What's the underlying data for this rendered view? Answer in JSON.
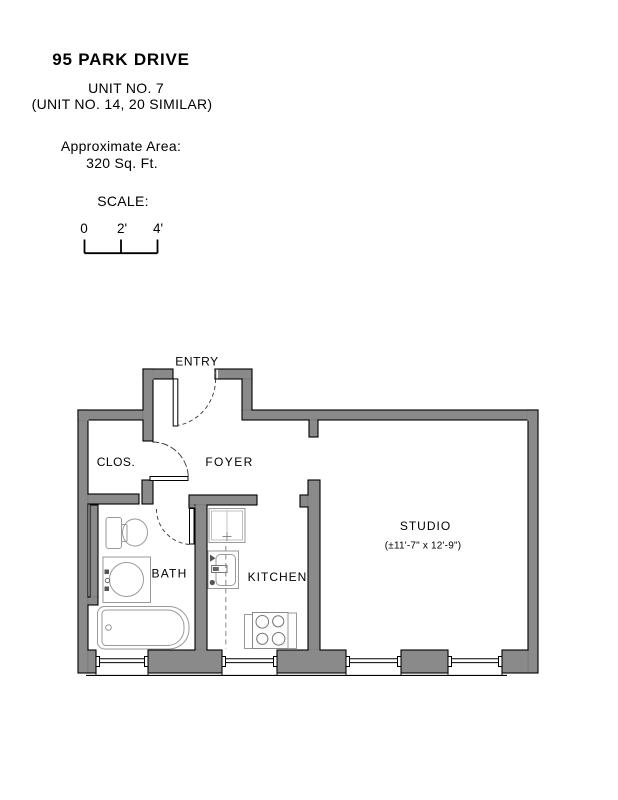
{
  "header": {
    "title": "95 PARK DRIVE",
    "unit_line1": "UNIT NO. 7",
    "unit_line2": "(UNIT NO. 14, 20 SIMILAR)",
    "area_label": "Approximate Area:",
    "area_value": "320 Sq. Ft."
  },
  "scale": {
    "label": "SCALE:",
    "ticks": [
      "0",
      "2'",
      "4'"
    ]
  },
  "plan": {
    "wall_color": "#8a8a8a",
    "labels": {
      "entry": "ENTRY",
      "closet": "CLOS.",
      "foyer": "FOYER",
      "bath": "BATH",
      "kitchen": "KITCHEN",
      "studio": "STUDIO",
      "studio_dims": "(±11'-7\" x 12'-9\")"
    }
  }
}
